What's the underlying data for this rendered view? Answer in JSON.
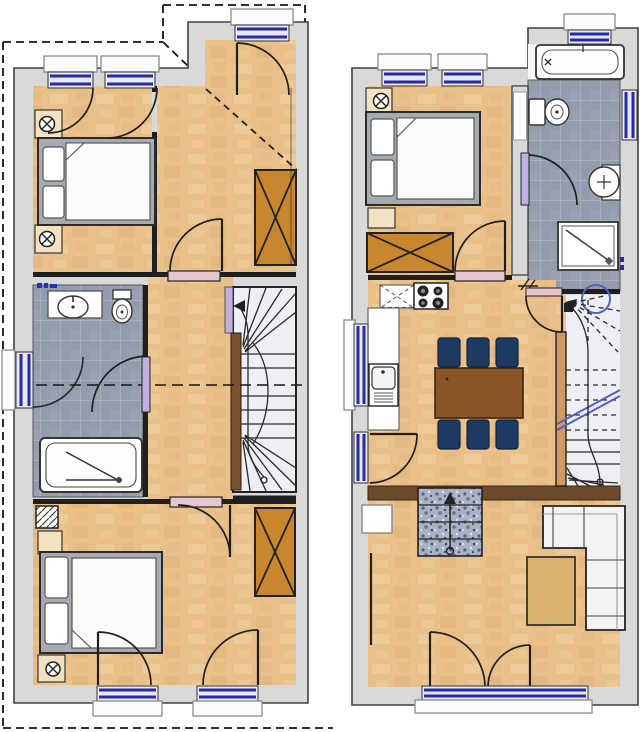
{
  "document": {
    "type": "floor-plan",
    "description": "Two residential floor plans side by side: upper attic floor (left) and main living floor (right)",
    "background": "#ffffff"
  },
  "colors": {
    "wall_fill": "#d9d9d9",
    "wall_stroke": "#414141",
    "line": "#1f1f1f",
    "wood": "#e9c08a",
    "wood_light": "#f4d7a8",
    "wood_dark": "#dcae72",
    "tile": "#939cac",
    "tile_line": "#aeb5c2",
    "stair_fill": "#edeff4",
    "stringer": "#7c5330",
    "banister": "#d09a62",
    "window_navy": "#2929a3",
    "window_fill": "#e7e9f6",
    "sill": "#fbfbfb",
    "door_pink": "#e6c6ce",
    "door_lavender": "#bfb0e0",
    "wardrobe_orange": "#c8872f",
    "table_brown": "#8a5527",
    "chair_navy": "#1d3a63",
    "band_brown": "#6b4a2c",
    "granite": "#a9b2c4",
    "sofa_white": "#f3f3f3",
    "coffee_tan": "#d9b36e",
    "bed_frame": "#a6abb2",
    "mattress": "#fbfbfb",
    "niche_tan": "#f2e2c2",
    "fixture": "#ffffff",
    "circle_blue": "#5560c0"
  },
  "plans": {
    "upper": {
      "label": "upper floor plan (left)",
      "rooms": [
        {
          "name": "bedroom-rear",
          "label": "rear bedroom",
          "furniture": [
            "double-bed",
            "radiator",
            "radiator",
            "casement-window",
            "casement-window"
          ]
        },
        {
          "name": "landing-hall",
          "label": "hall under roof slope",
          "furniture": [
            "wardrobe",
            "roof-slope-dashed-line",
            "balcony-window"
          ]
        },
        {
          "name": "bathroom",
          "label": "bathroom",
          "furniture": [
            "washbasin",
            "toilet",
            "bathtub",
            "window"
          ]
        },
        {
          "name": "hallway",
          "label": "hallway"
        },
        {
          "name": "stairs",
          "label": "winder staircase",
          "furniture": [
            "handrail",
            "walk-line-arrow"
          ]
        },
        {
          "name": "bedroom-front",
          "label": "front bedroom",
          "furniture": [
            "double-bed",
            "wardrobe",
            "chimney",
            "nightstand",
            "radiator",
            "french-window",
            "french-window"
          ]
        }
      ]
    },
    "main": {
      "label": "main floor plan (right)",
      "rooms": [
        {
          "name": "bedroom",
          "label": "bedroom",
          "furniture": [
            "double-bed",
            "radiator",
            "nightstand",
            "wardrobe"
          ]
        },
        {
          "name": "bathroom",
          "label": "bathroom",
          "furniture": [
            "bathtub",
            "toilet",
            "washbasin",
            "shower",
            "window",
            "window"
          ]
        },
        {
          "name": "kitchen-dining",
          "label": "kitchen and dining room",
          "furniture": [
            "upper-cabinets",
            "stove",
            "kitchen-counter",
            "kitchen-sink",
            "dining-table",
            "six-chairs",
            "entrance-door",
            "window"
          ]
        },
        {
          "name": "stairwell",
          "label": "winder staircase with break line",
          "furniture": [
            "handrail",
            "stairwell-circle",
            "walk-line-arrow"
          ]
        },
        {
          "name": "living-room",
          "label": "sunken living room",
          "furniture": [
            "corner-sofa",
            "coffee-table",
            "stone-steps",
            "wall-niche",
            "french-door",
            "window"
          ]
        }
      ]
    }
  },
  "annotations": {
    "boundary": "dashed outline around left plan",
    "section_line": "dashed section line across upper plan",
    "steps_arrow": "direction arrow on stone steps",
    "stair_circle": "stairwell opening circle"
  }
}
